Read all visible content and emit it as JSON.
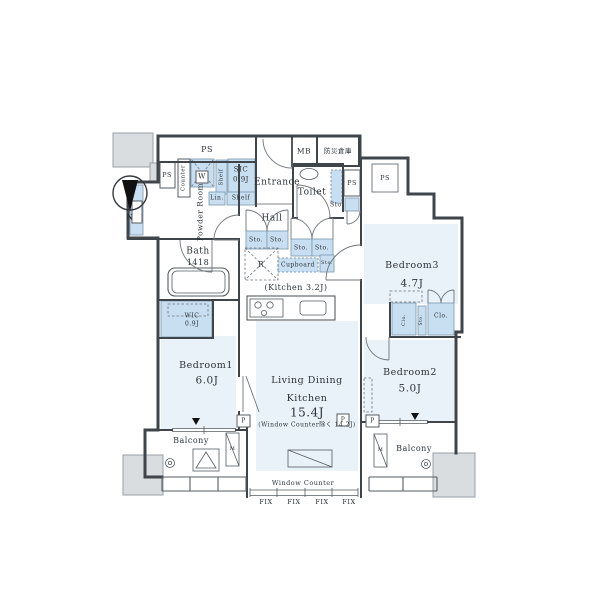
{
  "compass": {
    "north": "N"
  },
  "rooms": {
    "bedroom1": {
      "name": "Bedroom1",
      "size": "6.0J"
    },
    "bedroom2": {
      "name": "Bedroom2",
      "size": "5.0J"
    },
    "bedroom3": {
      "name": "Bedroom3",
      "size": "4.7J"
    },
    "ldk": {
      "line1": "Living Dining",
      "line2": "Kitchen",
      "size": "15.4J",
      "note": "(Window Counter除く 14.2J)"
    },
    "kitchen": {
      "label": "(Kitchen 3.2J)"
    },
    "bath": {
      "name": "Bath",
      "size": "1418"
    },
    "powder": {
      "line1": "Powder",
      "line2": "Room"
    },
    "toilet": {
      "name": "Toilet"
    },
    "entrance": {
      "name": "Entrance"
    },
    "hall": {
      "name": "Hall"
    },
    "wic": {
      "name": "WIC",
      "size": "0.9J"
    },
    "sic": {
      "name": "SIC",
      "size": "0.9J"
    },
    "balcony": {
      "name": "Balcony"
    },
    "bousai": {
      "name": "防災倉庫"
    }
  },
  "fixtures": {
    "ps": "PS",
    "mb": "MB",
    "sto": "Sto.",
    "shelf": "Shelf",
    "counter": "Counter",
    "lin": "Lin.",
    "cupboard": "Cupboard",
    "clo": "Clo.",
    "washer": "W",
    "fridge": "R",
    "pillar": "P",
    "pole": "M",
    "window_counter": "Window Counter",
    "fix": "FIX"
  }
}
